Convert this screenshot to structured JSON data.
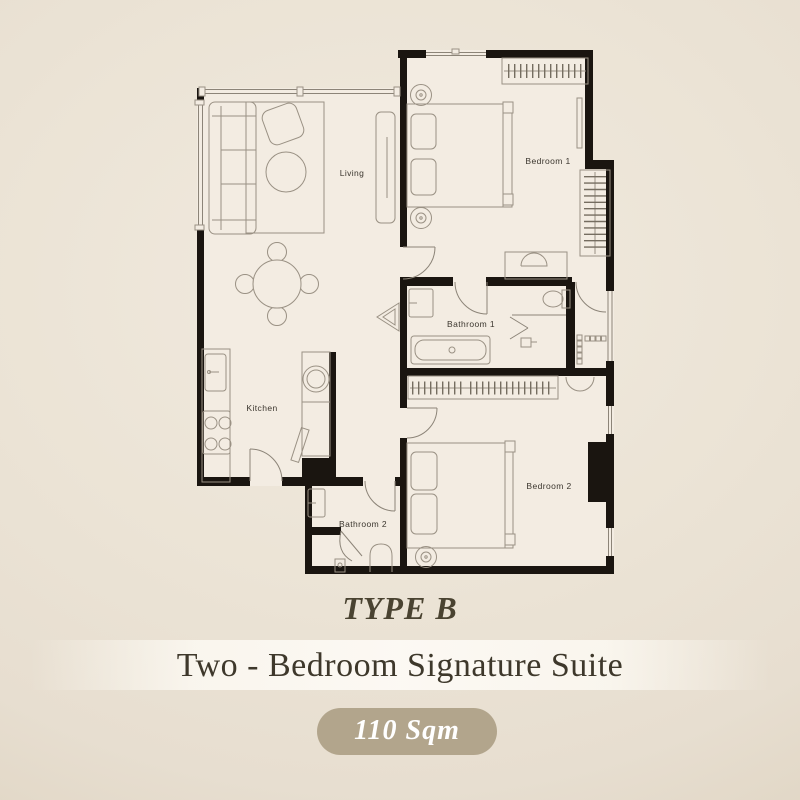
{
  "plan": {
    "type_label": "TYPE B",
    "name": "Two - Bedroom Signature Suite",
    "area": "110 Sqm",
    "rooms": {
      "living": "Living",
      "bedroom1": "Bedroom 1",
      "bathroom1": "Bathroom 1",
      "kitchen": "Kitchen",
      "bathroom2": "Bathroom 2",
      "bedroom2": "Bedroom 2"
    }
  },
  "colors": {
    "background": "#eae2d4",
    "room_fill": "#f3ece2",
    "wall": "#1a1510",
    "furniture_line": "#9a9184",
    "window_line": "#8c8478",
    "wardrobe_tick": "#756d60",
    "label_text": "#3b362e",
    "title_text": "#4a4331",
    "subtitle_text": "#3e382b",
    "badge_fill": "#b2a58c",
    "badge_text": "#ffffff"
  }
}
